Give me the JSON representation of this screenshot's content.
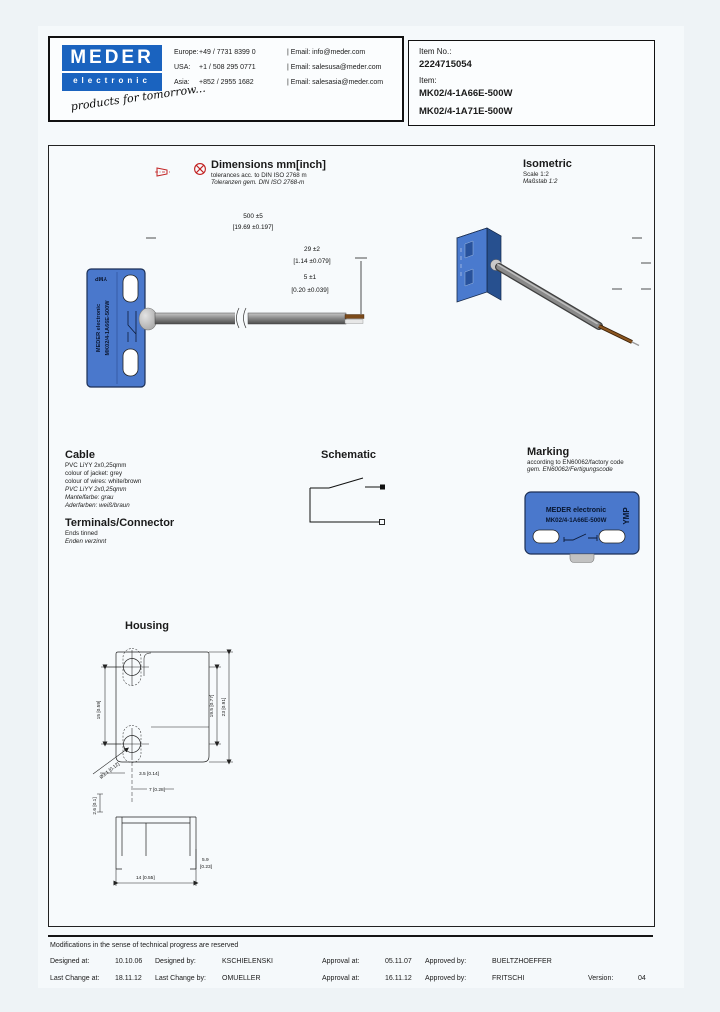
{
  "header": {
    "logo": {
      "name": "MEDER",
      "sub": "electronic",
      "tagline": "products for tomorrow..."
    },
    "contacts": [
      {
        "region": "Europe:",
        "phone": "+49 / 7731 8399 0",
        "email": "| Email: info@meder.com"
      },
      {
        "region": "USA:",
        "phone": "+1 / 508 295 0771",
        "email": "| Email: salesusa@meder.com"
      },
      {
        "region": "Asia:",
        "phone": "+852 / 2955 1682",
        "email": "| Email: salesasia@meder.com"
      }
    ],
    "item": {
      "no_label": "Item No.:",
      "no": "2224715054",
      "item_label": "Item:",
      "names": [
        "MK02/4-1A66E-500W",
        "MK02/4-1A71E-500W"
      ]
    }
  },
  "drawing": {
    "dimensions": {
      "title": "Dimensions mm[inch]",
      "tol_en": "tolerances acc. to DIN ISO 2768 m",
      "tol_de": "Toleranzen gem. DIN ISO 2768-m",
      "labels": {
        "overall": "500 ±5",
        "overall_in": "[19.69 ±0.197]",
        "mid": "29 ±2",
        "mid_in": "[1.14 ±0.079]",
        "end": "5 ±1",
        "end_in": "[0.20 ±0.039]"
      }
    },
    "isometric": {
      "title": "Isometric",
      "scale_en": "Scale 1:2",
      "scale_de": "Maßstab 1:2"
    },
    "part_label": {
      "brand": "MEDER electronic",
      "part": "MK02/4-1A66E-500W",
      "code": "YMP"
    },
    "cable": {
      "title": "Cable",
      "en": [
        "PVC LiYY 2x0,25qmm",
        "colour of jacket: grey",
        "colour of wires: white/brown"
      ],
      "de": [
        "PVC LiYY 2x0,25qmm",
        "Mantelfarbe: grau",
        "Aderfarben: weiß/braun"
      ]
    },
    "terminals": {
      "title": "Terminals/Connector",
      "en": "Ends tinned",
      "de": "Enden verzinnt"
    },
    "schematic": {
      "title": "Schematic"
    },
    "marking": {
      "title": "Marking",
      "en": "according to EN60062/factory code",
      "de": "gem. EN60062/Fertigungscode"
    },
    "housing": {
      "title": "Housing",
      "dims": {
        "hole_spacing": "15 [0.59]",
        "inner_height": "19.5 [0.77]",
        "height": "23 [0.91]",
        "hole_dia": "Ø3.1 [0.12]",
        "offset1": "3.5 [0.14]",
        "offset2": "7 [0.28]",
        "thickness": "2.6 [0.1]",
        "width": "14 [0.55]",
        "depth": "5.9",
        "depth_in": "[0.23]"
      }
    }
  },
  "footer": {
    "note": "Modifications in the sense of technical progress are reserved",
    "rows": [
      {
        "l1": "Designed at:",
        "v1": "10.10.06",
        "l2": "Designed by:",
        "v2": "KSCHIELENSKI",
        "l3": "Approval at:",
        "v3": "05.11.07",
        "l4": "Approved by:",
        "v4": "BUELTZHOEFFER",
        "l5": "",
        "v5": ""
      },
      {
        "l1": "Last Change at:",
        "v1": "18.11.12",
        "l2": "Last Change by:",
        "v2": "OMUELLER",
        "l3": "Approval at:",
        "v3": "16.11.12",
        "l4": "Approved by:",
        "v4": "FRITSCHI",
        "l5": "Version:",
        "v5": "04"
      }
    ]
  },
  "colors": {
    "brand_blue": "#1a63bf",
    "part_blue": "#4a78cc",
    "accent_red": "#c22222"
  }
}
